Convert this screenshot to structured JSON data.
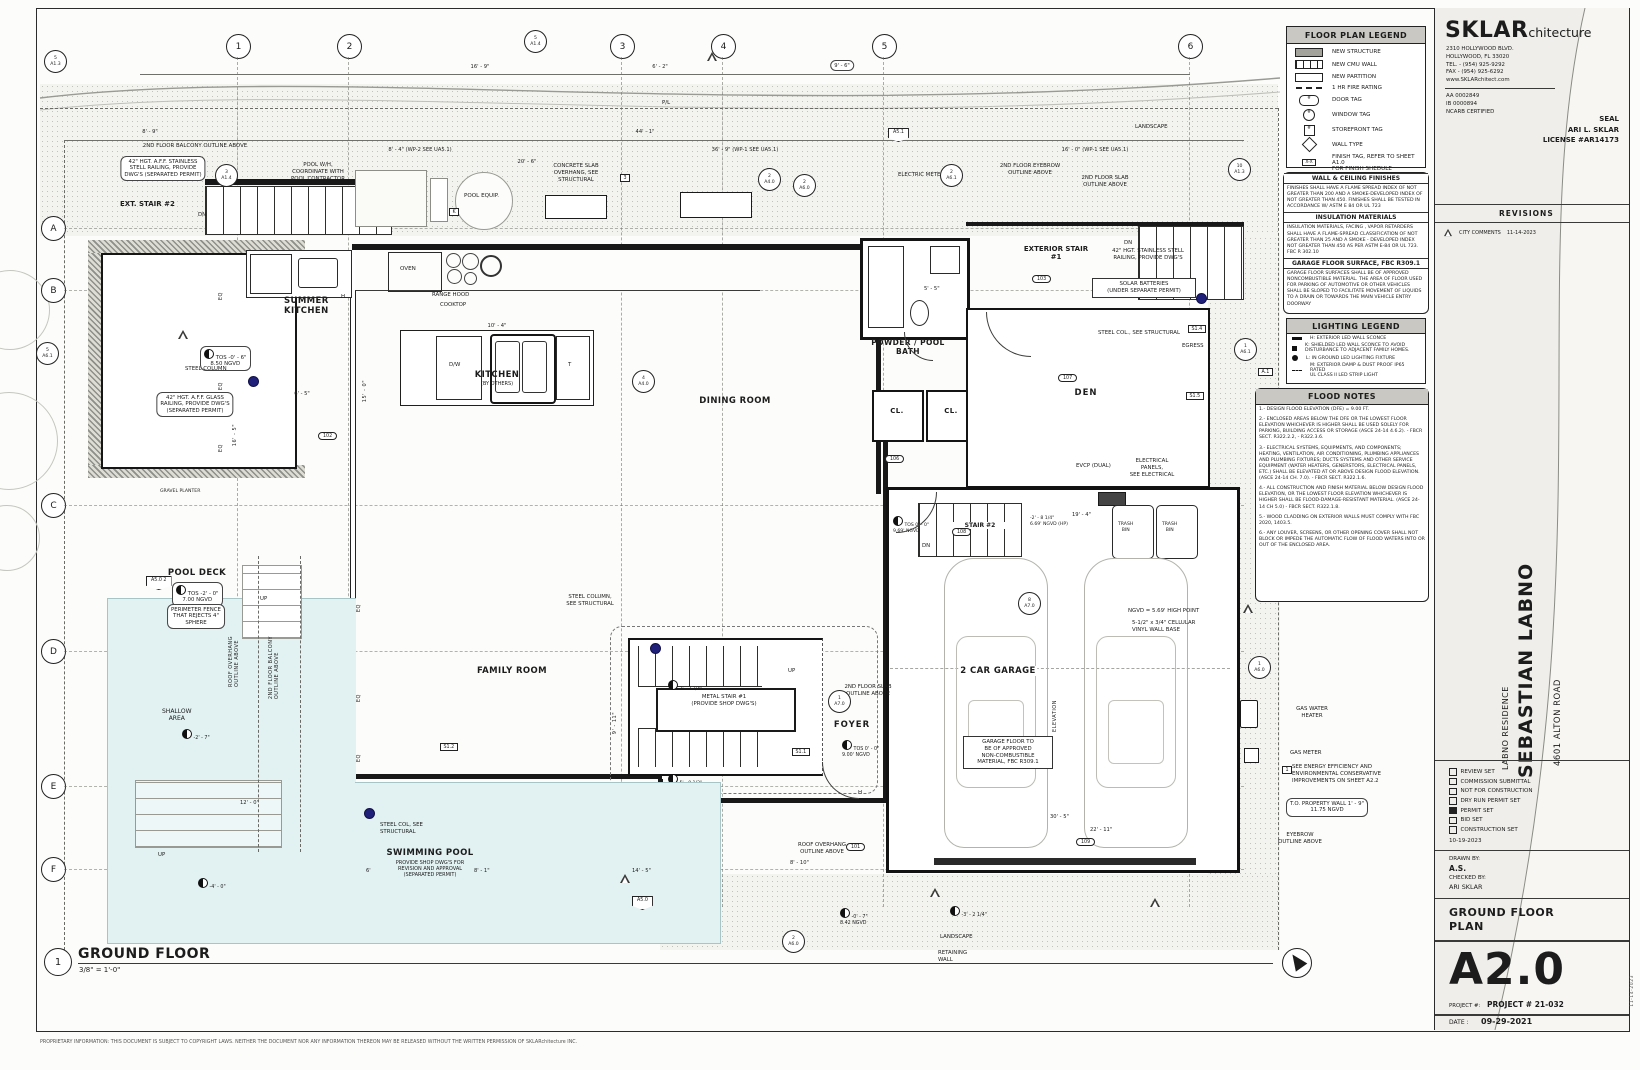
{
  "sheet": {
    "view_number": "1",
    "title": "GROUND FLOOR",
    "scale": "3/8\" = 1'-0\"",
    "footer": "PROPRIETARY INFORMATION: THIS DOCUMENT IS SUBJECT TO COPYRIGHT LAWS.  NEITHER THE DOCUMENT NOR ANY INFORMATION THEREON MAY BE RELEASED WITHOUT THE WRITTEN PERMISSION OF SKLARchitecture INC."
  },
  "legend": {
    "title": "FLOOR PLAN LEGEND",
    "items": [
      "NEW STRUCTURE",
      "NEW CMU WALL",
      "NEW PARTITION",
      "1 HR FIRE RATING",
      "DOOR TAG",
      "WINDOW TAG",
      "STOREFRONT TAG",
      "WALL TYPE",
      "FINISH TAG, REFER TO SHEET A1.0\nFOR FINISH SHEDULE"
    ],
    "finish_tag_symbol": "X-X",
    "hash": "#"
  },
  "finishes": {
    "sections": [
      {
        "h": "WALL & CEILING FINISHES",
        "b": "FINISHES SHALL HAVE A FLAME SPREAD INDEX OF NOT GREATER THAN 200 AND A SMOKE-DEVELOPED INDEX OF NOT GREATER THAN 450.  FINISHES SHALL BE TESTED IN ACCORDANCE W/ ASTM E 84 OR UL 723"
      },
      {
        "h": "INSULATION MATERIALS",
        "b": "INSULATION MATERIALS, FACING , VAPOR RETARDERS SHALL HAVE A FLAME-SPREAD CLASSIFICATION OF NOT GREATER THAN 25 AND A SMOKE - DEVELOPED INDEX NOT GREATER THAN 450 AS PER ASTM E-84 OR UL 723. FBC R 302.10"
      },
      {
        "h": "GARAGE FLOOR SURFACE, FBC R309.1",
        "b": "GARAGE FLOOR SURFACES SHALL BE OF APPROVED NONCOMBUSTIBLE MATERIAL. THE AREA OF FLOOR USED FOR PARKING OF AUTOMOTIVE OR OTHER VEHICLES SHALL BE SLOPED TO FACILITATE MOVEMENT OF LIQUIDS TO A DRAIN OR TOWARDS THE MAIN VEHICLE ENTRY DOORWAY"
      }
    ]
  },
  "lighting": {
    "title": "LIGHTING LEGEND",
    "items": [
      "H:  EXTERIOR LED WALL SCONCE",
      "K:  SHIELDED LED WALL SCONCE TO AVOID\nDISTURBANCE TO ADJACENT FAMILY HOMES.",
      "L:  IN GROUND LED LIGHTING FIXTURE",
      "M: EXTERIOR DAMP & DUST PROOF IP65 RATED\nUL CLASS II LED STRIP LIGHT"
    ]
  },
  "flood": {
    "title": "FLOOD NOTES",
    "notes": [
      "1.- DESIGN FLOOD ELEVATION (DFE) = 9.00 FT.",
      "2.- ENCLOSED AREAS BELOW THE DFE OR THE LOWEST FLOOR ELEVATION WHICHEVER IS HIGHER SHALL BE USED SOLELY FOR PARKING, BUILDING ACCESS OR STORAGE (ASCE 24-14 4.6.2). - FBCR SECT. R322.2.2, - R322.3.6.",
      "3.- ELECTRICAL SYSTEMS, EQUIPMENTS, AND COMPONENTS; HEATING, VENTILATION, AIR CONDITIONING, PLUMBING APPLIANCES AND PLUMBING FIXTURES; DUCTS SYSTEMS AND OTHER SERVICE EQUIPMENT (WATER HEATERS, GENERSTORS, ELECTRICAL PANELS, ETC.) SHALL BE ELEVATED AT OR ABOVE DESIGN FLOOD ELEVATION. (ASCE 24-14 CH. 7.0). - FBCR SECT. R322.1.6.",
      "4.- ALL CONSTRUCTION AND FINISH MATERIAL BELOW DESIGN FLOOD ELEVATION, OR THE LOWEST FLOOR ELEVATION WHICHEVER IS HIGHER SHALL BE FLOOD-DAMAGE-RESISTANT MATERIAL. (ASCE 24-14 CH 5.0) - FBCR SECT. R322.1.8.",
      "5.- WOOD CLADDING ON EXTERIOR WALLS MUST COMPLY WITH FBC 2020, 1403.5.",
      "6.- ANY LOUVER, SCREENS, OR OTHER OPENING COVER SHALL NOT BLOCK OR IMPEDE THE AUTOMATIC FLOW OF FLOOD WATERS INTO OR OUT OF THE ENCLOSED AREA."
    ]
  },
  "titleblock": {
    "firm": "SKLAR",
    "firm_suffix": "chitecture",
    "address": "2310 HOLLYWOOD BLVD.\nHOLLYWOOD, FL 33020\nTEL. - (954) 925-9292\nFAX - (954) 925-6292\nwww.SKLARchitect.com",
    "registrations": "AA 0002849\nIB 0000894\nNCARB CERTIFIED",
    "seal_label": "SEAL",
    "architect": "ARI L. SKLAR",
    "license": "LICENSE #AR14173",
    "revisions_label": "REVISIONS",
    "revision_no": "1",
    "revision_desc": "CITY COMMENTS",
    "revision_date": "11-14-2023",
    "residence": "LABNO RESIDENCE",
    "project_name": "SEBASTIAN LABNO",
    "project_address": "4601 ALTON ROAD",
    "sets": [
      {
        "label": "REVIEW SET",
        "checked": false
      },
      {
        "label": "COMMISSION SUBMITTAL",
        "checked": false
      },
      {
        "label": "NOT FOR CONSTRUCTION",
        "checked": false
      },
      {
        "label": "DRY RUN PERMIT SET",
        "checked": false
      },
      {
        "label": "PERMIT SET",
        "checked": true
      },
      {
        "label": "BID SET",
        "checked": false
      },
      {
        "label": "CONSTRUCTION SET",
        "checked": false
      }
    ],
    "set_date": "10-19-2023",
    "drawn_by_label": "DRAWN BY:",
    "drawn_by": "A.S.",
    "checked_by_label": "CHECKED BY:",
    "checked_by": "ARI SKLAR",
    "sheet_title": "GROUND FLOOR\nPLAN",
    "sheet_no": "A2.0",
    "project_no_label": "PROJECT #:",
    "project_no": "PROJECT # 21-032",
    "date_label": "DATE :",
    "date": "09-29-2021",
    "side_date": "11-14-2023"
  },
  "grid": {
    "cols": [
      "1",
      "2",
      "3",
      "4",
      "5",
      "6"
    ],
    "rows": [
      "A",
      "B",
      "C",
      "D",
      "E",
      "F"
    ]
  },
  "plan": {
    "rooms": {
      "summer_kitchen": "SUMMER\nKITCHEN",
      "kitchen": "KITCHEN",
      "kitchen_sub": "(BY OTHERS)",
      "dining": "DINING ROOM",
      "powder": "POWDER / POOL\nBATH",
      "cl": "CL.",
      "corridor": "CORRIDOR",
      "den": "DEN",
      "ext_stair1": "EXTERIOR STAIR\n#1",
      "ext_stair2": "EXT. STAIR #2",
      "family": "FAMILY ROOM",
      "foyer": "FOYER",
      "garage": "2 CAR GARAGE",
      "pool_deck": "POOL DECK",
      "shallow": "SHALLOW\nAREA",
      "pool": "SWIMMING POOL",
      "pool_sub": "PROVIDE SHOP DWG'S FOR\nREVISION AND APPROVAL\n(SEPARATED PERMIT)",
      "gravel": "GRAVEL PLANTER",
      "metal_stair": "METAL STAIR #1\n(PROVIDE SHOP DWG'S)",
      "stair2": "STAIR #2",
      "trash": "TRASH\nBIN",
      "oven": "OVEN",
      "pool_equip": "POOL EQUIP.",
      "dw": "D/W",
      "t": "T"
    },
    "ann": {
      "balcony_above": "2ND FLOOR BALCONY OUTLINE ABOVE",
      "ss_rail": "42\" HGT. A.F.F. STAINLESS\nSTELL RAILING, PROVIDE\nDWG'S (SEPARATED PERMIT)",
      "pool_wh": "POOL W/H,\nCOORDINATE WITH\nPOOL CONTRACTOR",
      "slab_overhang": "CONCRETE SLAB\nOVERHANG, SEE\nSTRUCTURAL",
      "range_hood": "RANGE HOOD",
      "cooktop": "COOKTOP",
      "electric_meter": "ELECTRIC METER",
      "eyebrow_above": "2ND FLOOR EYEBROW\nOUTLINE ABOVE",
      "slab_above": "2ND FLOOR SLAB\nOUTLINE ABOVE",
      "ss_rail2": "42\" HGT. STAINLESS STELL\nRAILING, PROVIDE DWG'S",
      "solar": "SOLAR BATTERIES\n(UNDER SEPARATE PERMIT)",
      "steel_col_struct": "STEEL COL., SEE STRUCTURAL",
      "egress": "EGRESS",
      "steel_column": "STEEL COLUMN",
      "glass_rail": "42\" HGT. A.F.F. GLASS\nRAILING, PROVIDE DWG'S\n(SEPARATED PERMIT)",
      "steel_col2": "STEEL COLUMN,\nSEE STRUCTURAL",
      "perimeter_fence": "PERIMETER FENCE\nTHAT REJECTS 4\"\nSPHERE",
      "roof_overhang_v": "ROOF OVERHANG\nOUTLINE ABOVE",
      "balcony_v": "2ND FLOOR BALCONY\nOUTLINE ABOVE",
      "evcp": "EVCP (DUAL)",
      "elec_panels": "ELECTRICAL\nPANELS,\nSEE ELECTRICAL",
      "ngvd_high": "NGVD = 5.69' HIGH POINT",
      "vinyl_base": "5-1/2\" x 3/4\" CELLULAR\nVINYL WALL BASE",
      "gas_wh": "GAS WATER\nHEATER",
      "gas_meter": "GAS METER",
      "energy": "SEE ENERGY EFFICIENCY AND\nENVIRONMENTAL CONSERVATIVE\nIMPROVEMENTS ON SHEET A2.2",
      "property_wall": "T.O. PROPERTY WALL 1' - 9\"\n11.75 NGVD",
      "eyebrow2": "EYEBROW\nOUTLINE ABOVE",
      "garage_floor": "GARAGE FLOOR TO\nBE OF APPROVED\nNON-COMBUSTIBLE\nMATERIAL, FBC R309.1",
      "roof_overhang2": "ROOF OVERHANG\nOUTLINE ABOVE",
      "landscape": "LANDSCAPE",
      "retaining": "RETAINING\nWALL",
      "steel_col3": "STEEL COL, SEE\nSTRUCTURAL",
      "elevation_v": "ELEVATION",
      "pl": "P/L"
    },
    "elev": {
      "terrace": "TOS -0' - 6\"\n8.50 NGVD",
      "pool_deck": "TOS -2' - 0\"\n7.00 NGVD",
      "foyer": "TOS 0' - 0\"\n9.00' NGVD",
      "stair2_top": "TOS 0' - 0\"\n9.69' NGVD",
      "garage_hp": "-2' - 8 1/4\"\n6.69' NGVD (HP)",
      "shallow": "-2' - 7\"",
      "deep": "-4' - 0\"",
      "overhang": "-0' - 7\"\n8.42 NGVD",
      "landscape": "-3' - 2 1/4\"",
      "stair_mid": "3' - 7 3/4\"",
      "stair_low": "5' - 0 1/2\""
    },
    "dims": {
      "d1": "8' - 9\"",
      "d2": "16' - 9\"",
      "d3": "6' - 2\"",
      "d4": "9' - 6\"",
      "d5": "44' - 1\"",
      "d6": "36' - 9\" (WP-1 SEE UA5.1)",
      "d7": "8' - 4\" (WP-2 SEE UA5.1)",
      "d8": "16' - 0\" (WP-1 SEE UA5.1)",
      "d9": "20' - 6\"",
      "d10": "10' - 4\"",
      "d11": "15' - 0\"",
      "d12": "16' - 5\"",
      "d13": "6' - 5\"",
      "d14": "12' - 0\"",
      "d15": "6'",
      "d16": "8' - 1\"",
      "d17": "14' - 5\"",
      "d18": "19' - 4\"",
      "d19": "30' - 5\"",
      "d20": "22' - 11\"",
      "d21": "9' - 11\"",
      "d23": "5' - 5\"",
      "d24": "8' - 10\""
    },
    "tags": {
      "a14_top": "5\nA1.4",
      "a14_terr": "3\nA1.4",
      "a13_l": "5\nA1.3",
      "a13_r": "10\nA1.3",
      "a40_1": "2\nA4.0",
      "a61_1": "2\nA6.1",
      "a51": "A5.1",
      "a40_2": "4\nA4.0",
      "a70_foyer": "1\nA7.0",
      "a70_garage": "8\nA7.0",
      "a60": "2\nA6.0",
      "a60_b": "2\nA6.0",
      "a61_l": "5\nA6.1",
      "a61_r": "1\nA6.1",
      "a60_r": "1\nA6.0",
      "a50": "A5.0",
      "a50_l": "A5.0  2",
      "s11": "S1.1",
      "s12": "S1.2",
      "s13": "S1.3",
      "s14": "S1.4",
      "s15": "S1.5",
      "r101": "101",
      "r102": "102",
      "r103": "103",
      "r104": "104",
      "r105": "105",
      "r106": "106",
      "r107": "107",
      "r108": "108",
      "r109": "109",
      "k": "K",
      "n3": "3",
      "n1": "1",
      "a1": "A.1",
      "a2": "A.2"
    },
    "misc": {
      "up": "UP",
      "dn": "DN",
      "eq": "EQ",
      "h": "H",
      "north": "N"
    }
  }
}
